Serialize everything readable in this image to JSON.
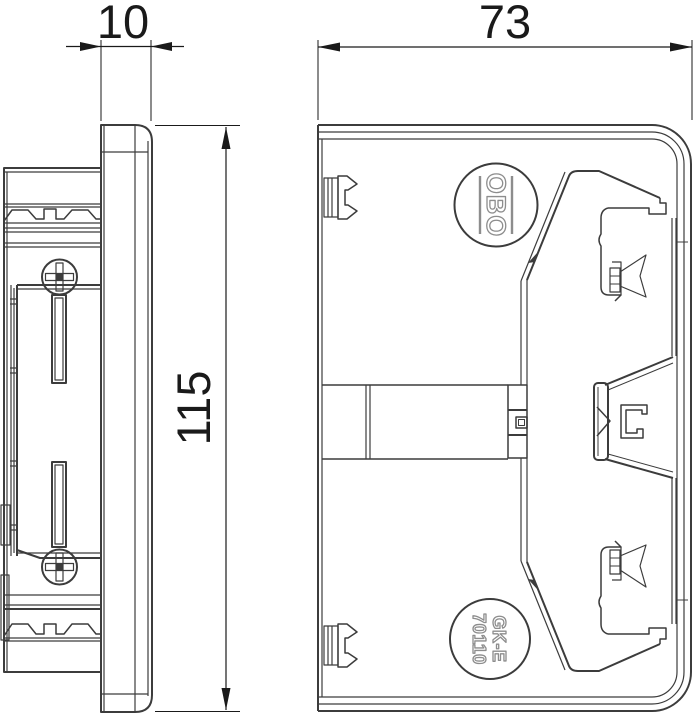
{
  "dimensions": {
    "lid_width": {
      "value": "10"
    },
    "front_width": {
      "value": "73"
    },
    "height": {
      "value": "115"
    }
  },
  "markings": {
    "logo": "OBO",
    "part_line1": "GK-E",
    "part_line2": "70110"
  },
  "colors": {
    "line": "#3c3c3c",
    "dimension": "#1a1a1a",
    "marking_outline": "#8d8d8d",
    "background": "#ffffff"
  }
}
